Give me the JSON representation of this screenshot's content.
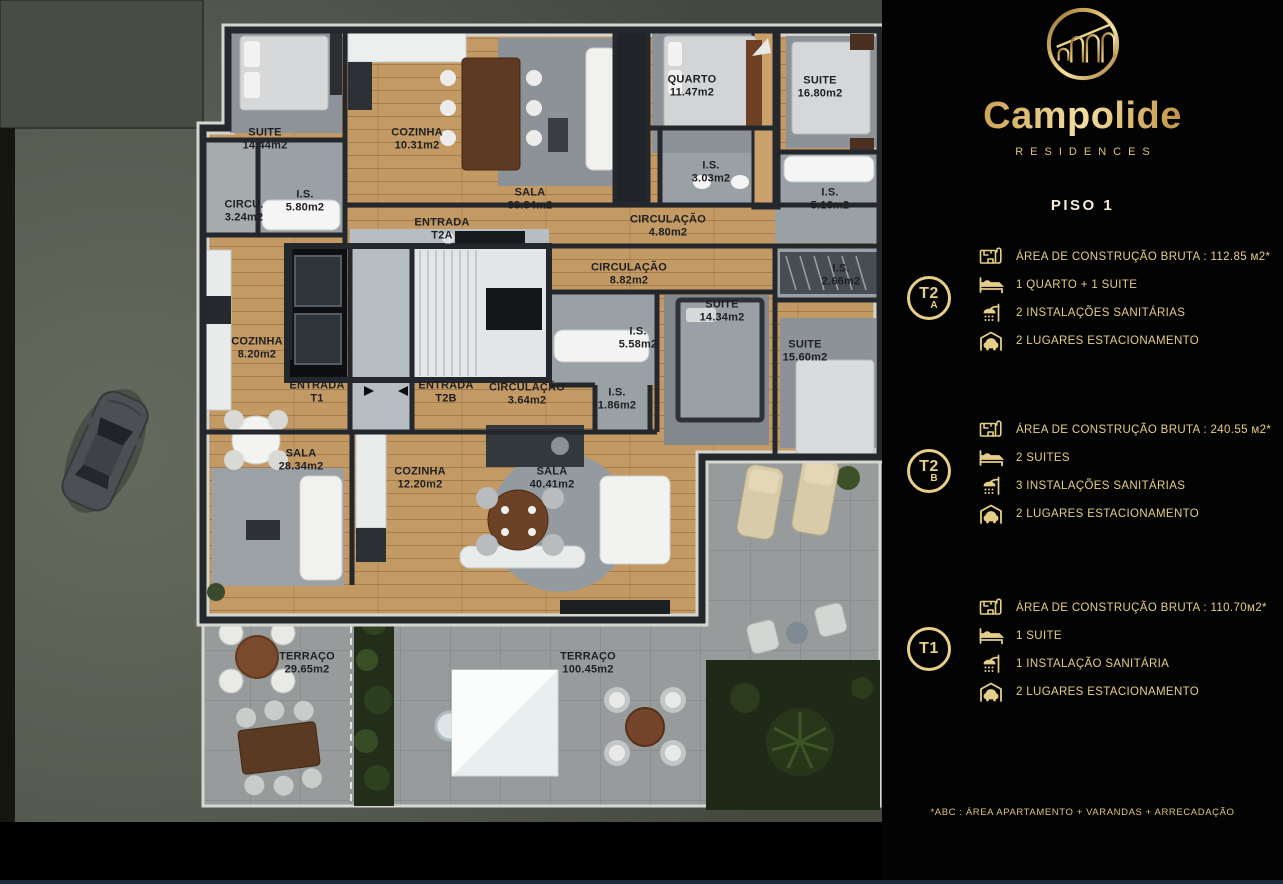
{
  "panel": {
    "brand": {
      "name": "Campolide",
      "tagline": "RESIDENCES"
    },
    "floor_title": "PISO 1",
    "units": [
      {
        "code": "T2",
        "variant": "A",
        "rows": [
          {
            "icon": "floorplan-icon",
            "text": "ÁREA DE CONSTRUÇÃO BRUTA :  112.85 м2*"
          },
          {
            "icon": "bed-icon",
            "text": "1 QUARTO + 1 SUITE"
          },
          {
            "icon": "shower-icon",
            "text": "2 INSTALAÇÕES SANITÁRIAS"
          },
          {
            "icon": "garage-icon",
            "text": "2 LUGARES ESTACIONAMENTO"
          }
        ]
      },
      {
        "code": "T2",
        "variant": "B",
        "rows": [
          {
            "icon": "floorplan-icon",
            "text": "ÁREA DE CONSTRUÇÃO BRUTA :  240.55 м2*"
          },
          {
            "icon": "bed-icon",
            "text": "2 SUITES"
          },
          {
            "icon": "shower-icon",
            "text": "3 INSTALAÇÕES SANITÁRIAS"
          },
          {
            "icon": "garage-icon",
            "text": "2 LUGARES ESTACIONAMENTO"
          }
        ]
      },
      {
        "code": "T1",
        "variant": "",
        "rows": [
          {
            "icon": "floorplan-icon",
            "text": "ÁREA DE CONSTRUÇÃO BRUTA :  110.70м2*"
          },
          {
            "icon": "bed-icon",
            "text": "1 SUITE"
          },
          {
            "icon": "shower-icon",
            "text": "1 INSTALAÇÃO SANITÁRIA"
          },
          {
            "icon": "garage-icon",
            "text": "2 LUGARES ESTACIONAMENTO"
          }
        ]
      }
    ],
    "footnote": "*ABC :  ÁREA APARTAMENTO + VARANDAS + ARRECADAÇÃO"
  },
  "floorplan": {
    "rooms": [
      {
        "name": "SUITE",
        "area": "14.44m2",
        "x": 265,
        "y": 139
      },
      {
        "name": "COZINHA",
        "area": "10.31m2",
        "x": 417,
        "y": 139
      },
      {
        "name": "I.S.",
        "area": "5.80m2",
        "x": 305,
        "y": 201
      },
      {
        "name": "CIRCU.",
        "area": "3.24m2",
        "x": 244,
        "y": 211
      },
      {
        "name": "SALA",
        "area": "38.84m2",
        "x": 530,
        "y": 199
      },
      {
        "name": "QUARTO",
        "area": "11.47m2",
        "x": 692,
        "y": 86
      },
      {
        "name": "SUITE",
        "area": "16.80m2",
        "x": 820,
        "y": 87
      },
      {
        "name": "I.S.",
        "area": "3.03m2",
        "x": 711,
        "y": 172
      },
      {
        "name": "CIRCULAÇÃO",
        "area": "4.80m2",
        "x": 668,
        "y": 226
      },
      {
        "name": "I.S.",
        "area": "5.16m2",
        "x": 830,
        "y": 199
      },
      {
        "name": "CIRCULAÇÃO",
        "area": "8.82m2",
        "x": 629,
        "y": 274
      },
      {
        "name": "I.S.",
        "area": "2.66m2",
        "x": 841,
        "y": 275
      },
      {
        "name": "SUITE",
        "area": "14.34m2",
        "x": 722,
        "y": 311
      },
      {
        "name": "I.S.",
        "area": "5.58m2",
        "x": 638,
        "y": 338
      },
      {
        "name": "SUITE",
        "area": "15.60m2",
        "x": 805,
        "y": 351
      },
      {
        "name": "COZINHA",
        "area": "8.20m2",
        "x": 257,
        "y": 348
      },
      {
        "name": "CIRCULAÇÃO",
        "area": "3.64m2",
        "x": 527,
        "y": 394
      },
      {
        "name": "I.S.",
        "area": "1.86m2",
        "x": 617,
        "y": 399
      },
      {
        "name": "SALA",
        "area": "28.34m2",
        "x": 301,
        "y": 460
      },
      {
        "name": "COZINHA",
        "area": "12.20m2",
        "x": 420,
        "y": 478
      },
      {
        "name": "SALA",
        "area": "40.41m2",
        "x": 552,
        "y": 478
      },
      {
        "name": "TERRAÇO",
        "area": "29.65m2",
        "x": 307,
        "y": 663
      },
      {
        "name": "TERRAÇO",
        "area": "100.45m2",
        "x": 588,
        "y": 663
      }
    ],
    "entrances": [
      {
        "label": "ENTRADA",
        "unit": "T2A",
        "x": 442,
        "y": 229
      },
      {
        "label": "ENTRADA",
        "unit": "T1",
        "x": 317,
        "y": 392
      },
      {
        "label": "ENTRADA",
        "unit": "T2B",
        "x": 446,
        "y": 392
      }
    ]
  }
}
